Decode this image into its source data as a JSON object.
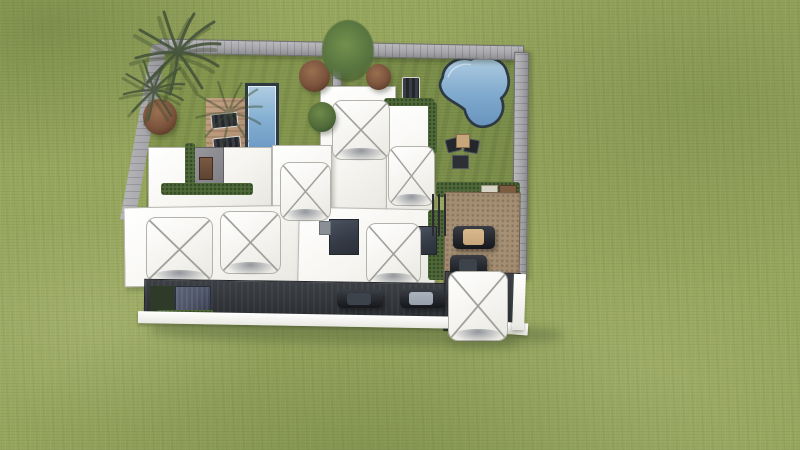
{
  "scene": {
    "type": "aerial-architectural-rendering",
    "style": "colored-pencil sketch render, top-down view",
    "description": "Aerial view of a modern walled villa compound on a large textured lawn. Left garden: rectangular lap pool with wood deck and two sun loungers, shrubs and palm trees at the north-west corner. Right garden: freeform pool, a sun lounger and a four-piece seating set. Center: white flat roofs with seven pyramidal canopy skylights and two dark courtyard openings. Right: gravel car court with two parked cars behind a slatted fence. Bottom: dark asphalt driveway with two cars, a blue-gray garage gate and a white entrance canopy."
  },
  "palette": {
    "grass_base": "#98a75e",
    "garden_grass": "#85974f",
    "garden_grass_right": "#7c8f4b",
    "wall_stone": "#a7a7ab",
    "roof_white": "#f6f5f1",
    "pool_light": "#b0cde2",
    "pool_mid": "#6f9cc7",
    "pool_rim": "#2e3a43",
    "deck_wood": "#b29175",
    "dirt_court": "#9c8569",
    "asphalt": "#33363a",
    "hedge_green": "#4f6a38",
    "bush_brown": "#7a523c",
    "palm_green": "#46543b",
    "car_dark": "#23262b",
    "car_tan": "#c7a67c",
    "car_gray": "#98a1ab",
    "curb_white": "#e9e8e2",
    "gate_blue": "#4e5568"
  },
  "elements": {
    "lawn": {
      "label": "surrounding lawn"
    },
    "compound_wall": {
      "label": "stone perimeter wall",
      "sides": [
        "north",
        "west",
        "east"
      ]
    },
    "left_garden": {
      "lap_pool": 1,
      "deck_loungers": 2,
      "shrubs": 3
    },
    "right_garden": {
      "freeform_pool": 1,
      "sun_lounger": 1,
      "seating_chairs": 2,
      "tables": 2
    },
    "roofs": {
      "canopy_skylights": 7,
      "courtyard_openings": 2,
      "service_door": 1
    },
    "car_court": {
      "surface": "gravel",
      "cars": 2,
      "fence": "slatted"
    },
    "driveway": {
      "surface": "asphalt",
      "cars": 2,
      "garage_gate": 1
    },
    "entrance_canopy": {
      "count": 1
    },
    "palm_trees": {
      "count": 3
    },
    "hedges": {
      "count": 6
    }
  }
}
